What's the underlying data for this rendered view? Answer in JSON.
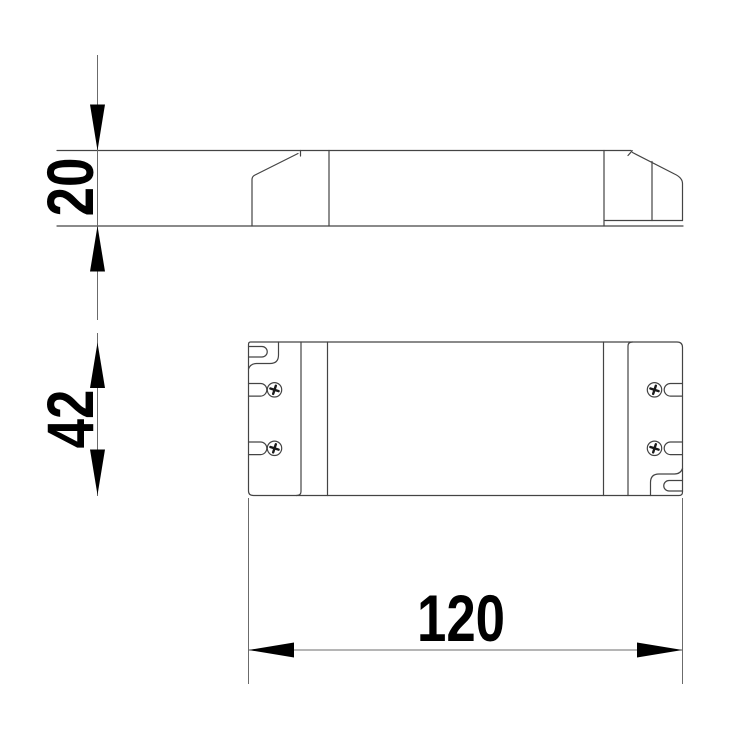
{
  "drawing": {
    "kind": "technical-dimension-drawing",
    "dimensions": {
      "height": "20",
      "width": "42",
      "length": "120"
    },
    "colors": {
      "outline": "#444444",
      "dimension_line": "#6b6b6b",
      "annotation": "#000000",
      "background": "#ffffff"
    }
  }
}
